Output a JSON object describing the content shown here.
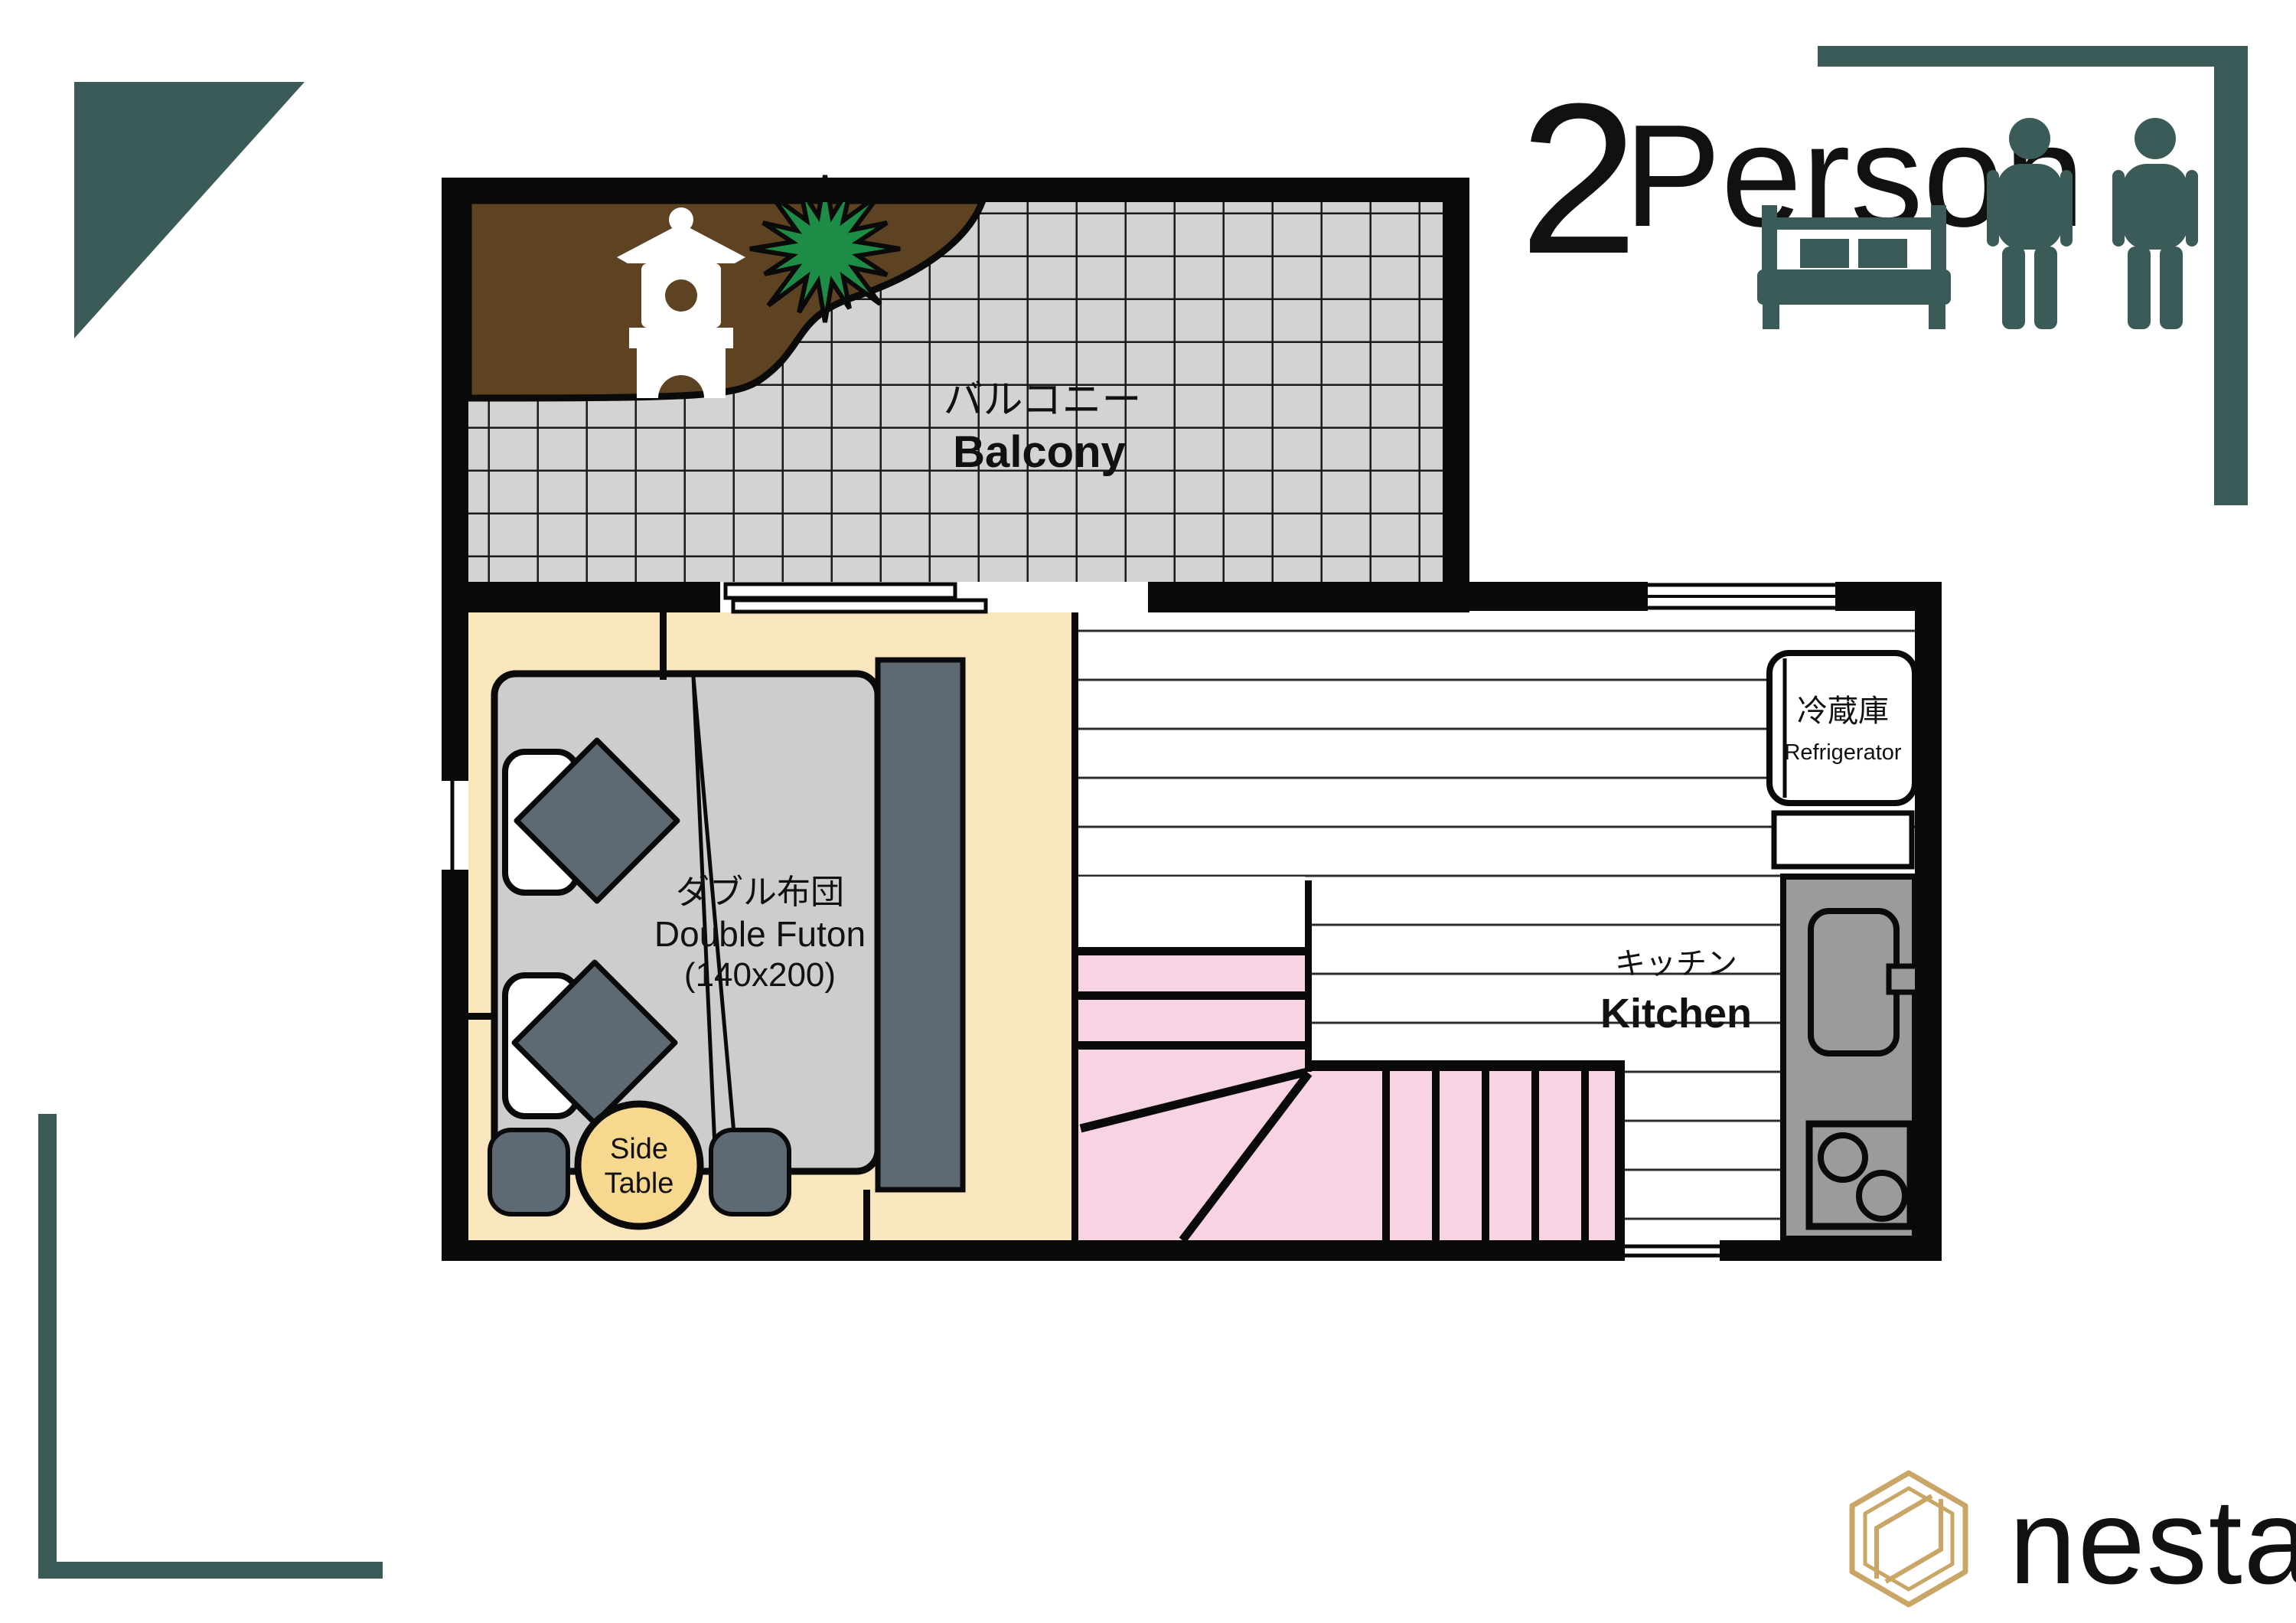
{
  "header": {
    "capacity_number": "2",
    "capacity_label": "Person"
  },
  "plan": {
    "balcony": {
      "label_ja": "バルコニー",
      "label_en": "Balcony"
    },
    "bedroom": {
      "futon_label_ja": "ダブル布団",
      "futon_label_en": "Double Futon",
      "futon_size": "(140x200)",
      "side_table_line1": "Side",
      "side_table_line2": "Table"
    },
    "kitchen": {
      "label_ja": "キッチン",
      "label_en": "Kitchen",
      "refrigerator_label_ja": "冷蔵庫",
      "refrigerator_label_en": "Refrigerator"
    }
  },
  "brand": {
    "name": "nestay"
  },
  "colors": {
    "accent_teal": "#3a5b58",
    "brand_gold": "#c9a566",
    "wall_black": "#0a0a0a",
    "balcony_tile_gray": "#d3d3d3",
    "garden_brown": "#5d4322",
    "plant_green": "#1d8c46",
    "bedroom_cream": "#f9e6bc",
    "futon_gray": "#cdcdcd",
    "slate_gray": "#5d6a73",
    "stairs_pink": "#f8d3e4",
    "counter_gray": "#9b9b9b",
    "side_table_yellow": "#f6d88f"
  }
}
